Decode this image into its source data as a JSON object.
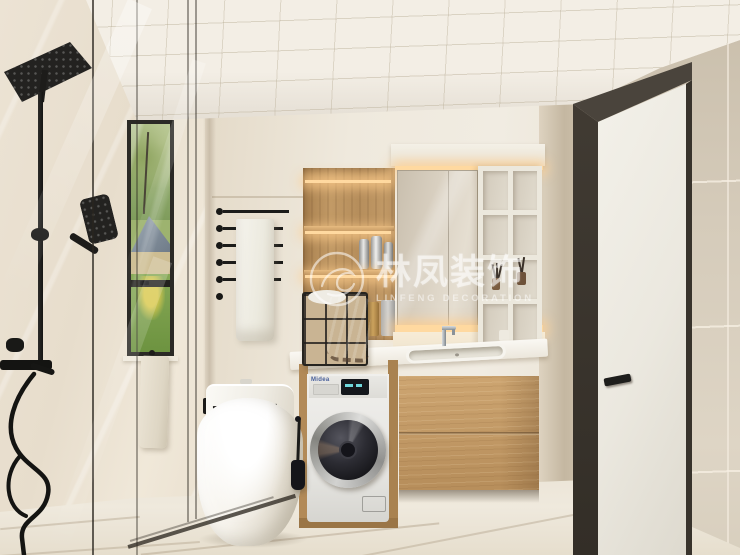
{
  "scene": {
    "description": "3D interior rendering of a modern bathroom with walk-in shower, smart toilet, laundry column and wood vanity"
  },
  "watermark": {
    "brand_cn": "林凤装饰",
    "brand_en": "LINFENG DECORATION"
  },
  "appliance": {
    "washer_brand": "Midea"
  },
  "palette": {
    "wall_beige": "#efe9dd",
    "right_wall_tile": "#d3c9b8",
    "wood": "#c09a66",
    "fixture_black": "#1c1c1a",
    "led_glow": "#ffd9a0",
    "counter_white": "#f7f5ef",
    "floor": "#ece5d8",
    "window_green": "#7fa24d"
  }
}
